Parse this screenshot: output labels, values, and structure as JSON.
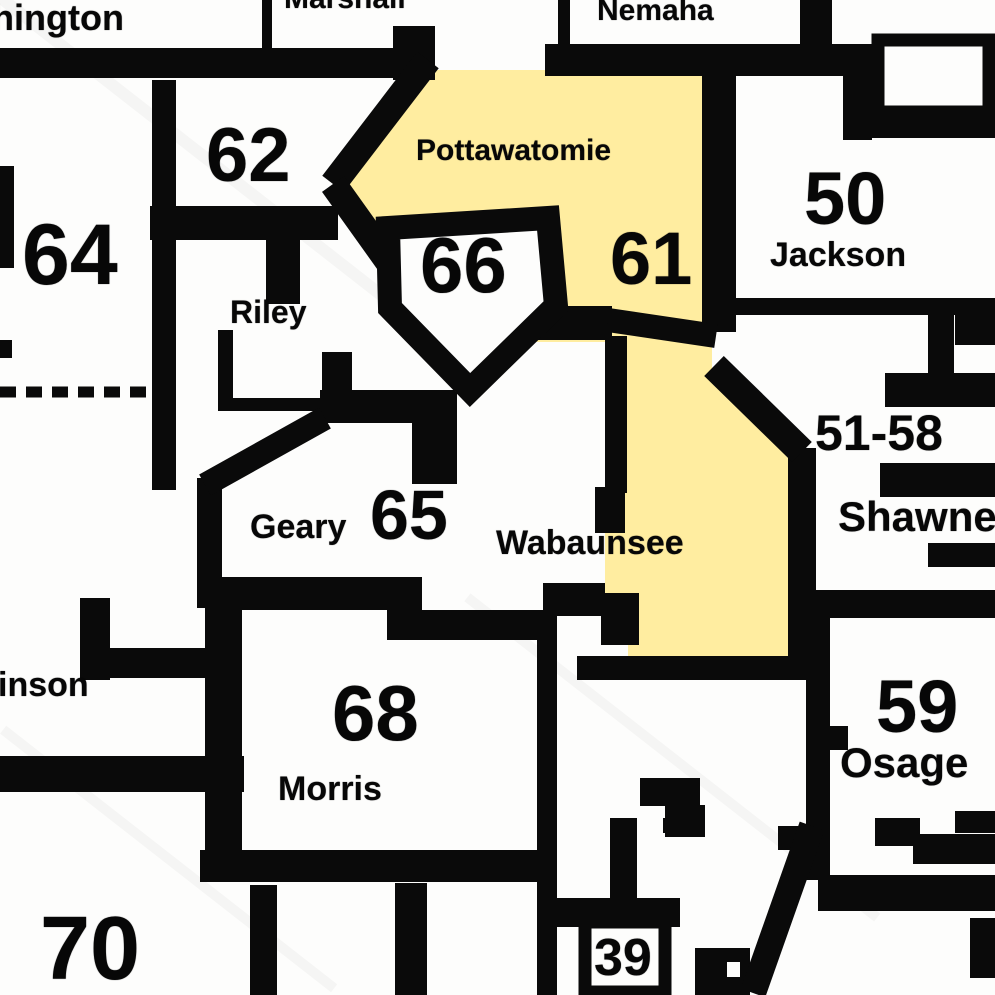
{
  "map": {
    "description": "Scanned county / legislative district map detail",
    "highlighted_district": "61",
    "colors": {
      "highlight": "#FFEDA0",
      "border": "#0a0a0a",
      "background": "#FDFDFC"
    },
    "counties": {
      "washington_partial": "hington",
      "marshall": "Marshall",
      "nemaha": "Nemaha",
      "pottawatomie": "Pottawatomie",
      "jackson": "Jackson",
      "riley": "Riley",
      "geary": "Geary",
      "wabaunsee": "Wabaunsee",
      "shawnee": "Shawnee",
      "dickinson_partial": "inson",
      "morris": "Morris",
      "osage": "Osage"
    },
    "districts": {
      "d62": "62",
      "d64": "64",
      "d66": "66",
      "d61": "61",
      "d50": "50",
      "d65": "65",
      "d51_58": "51-58",
      "d68": "68",
      "d59": "59",
      "d70": "70",
      "d39": "39"
    }
  }
}
